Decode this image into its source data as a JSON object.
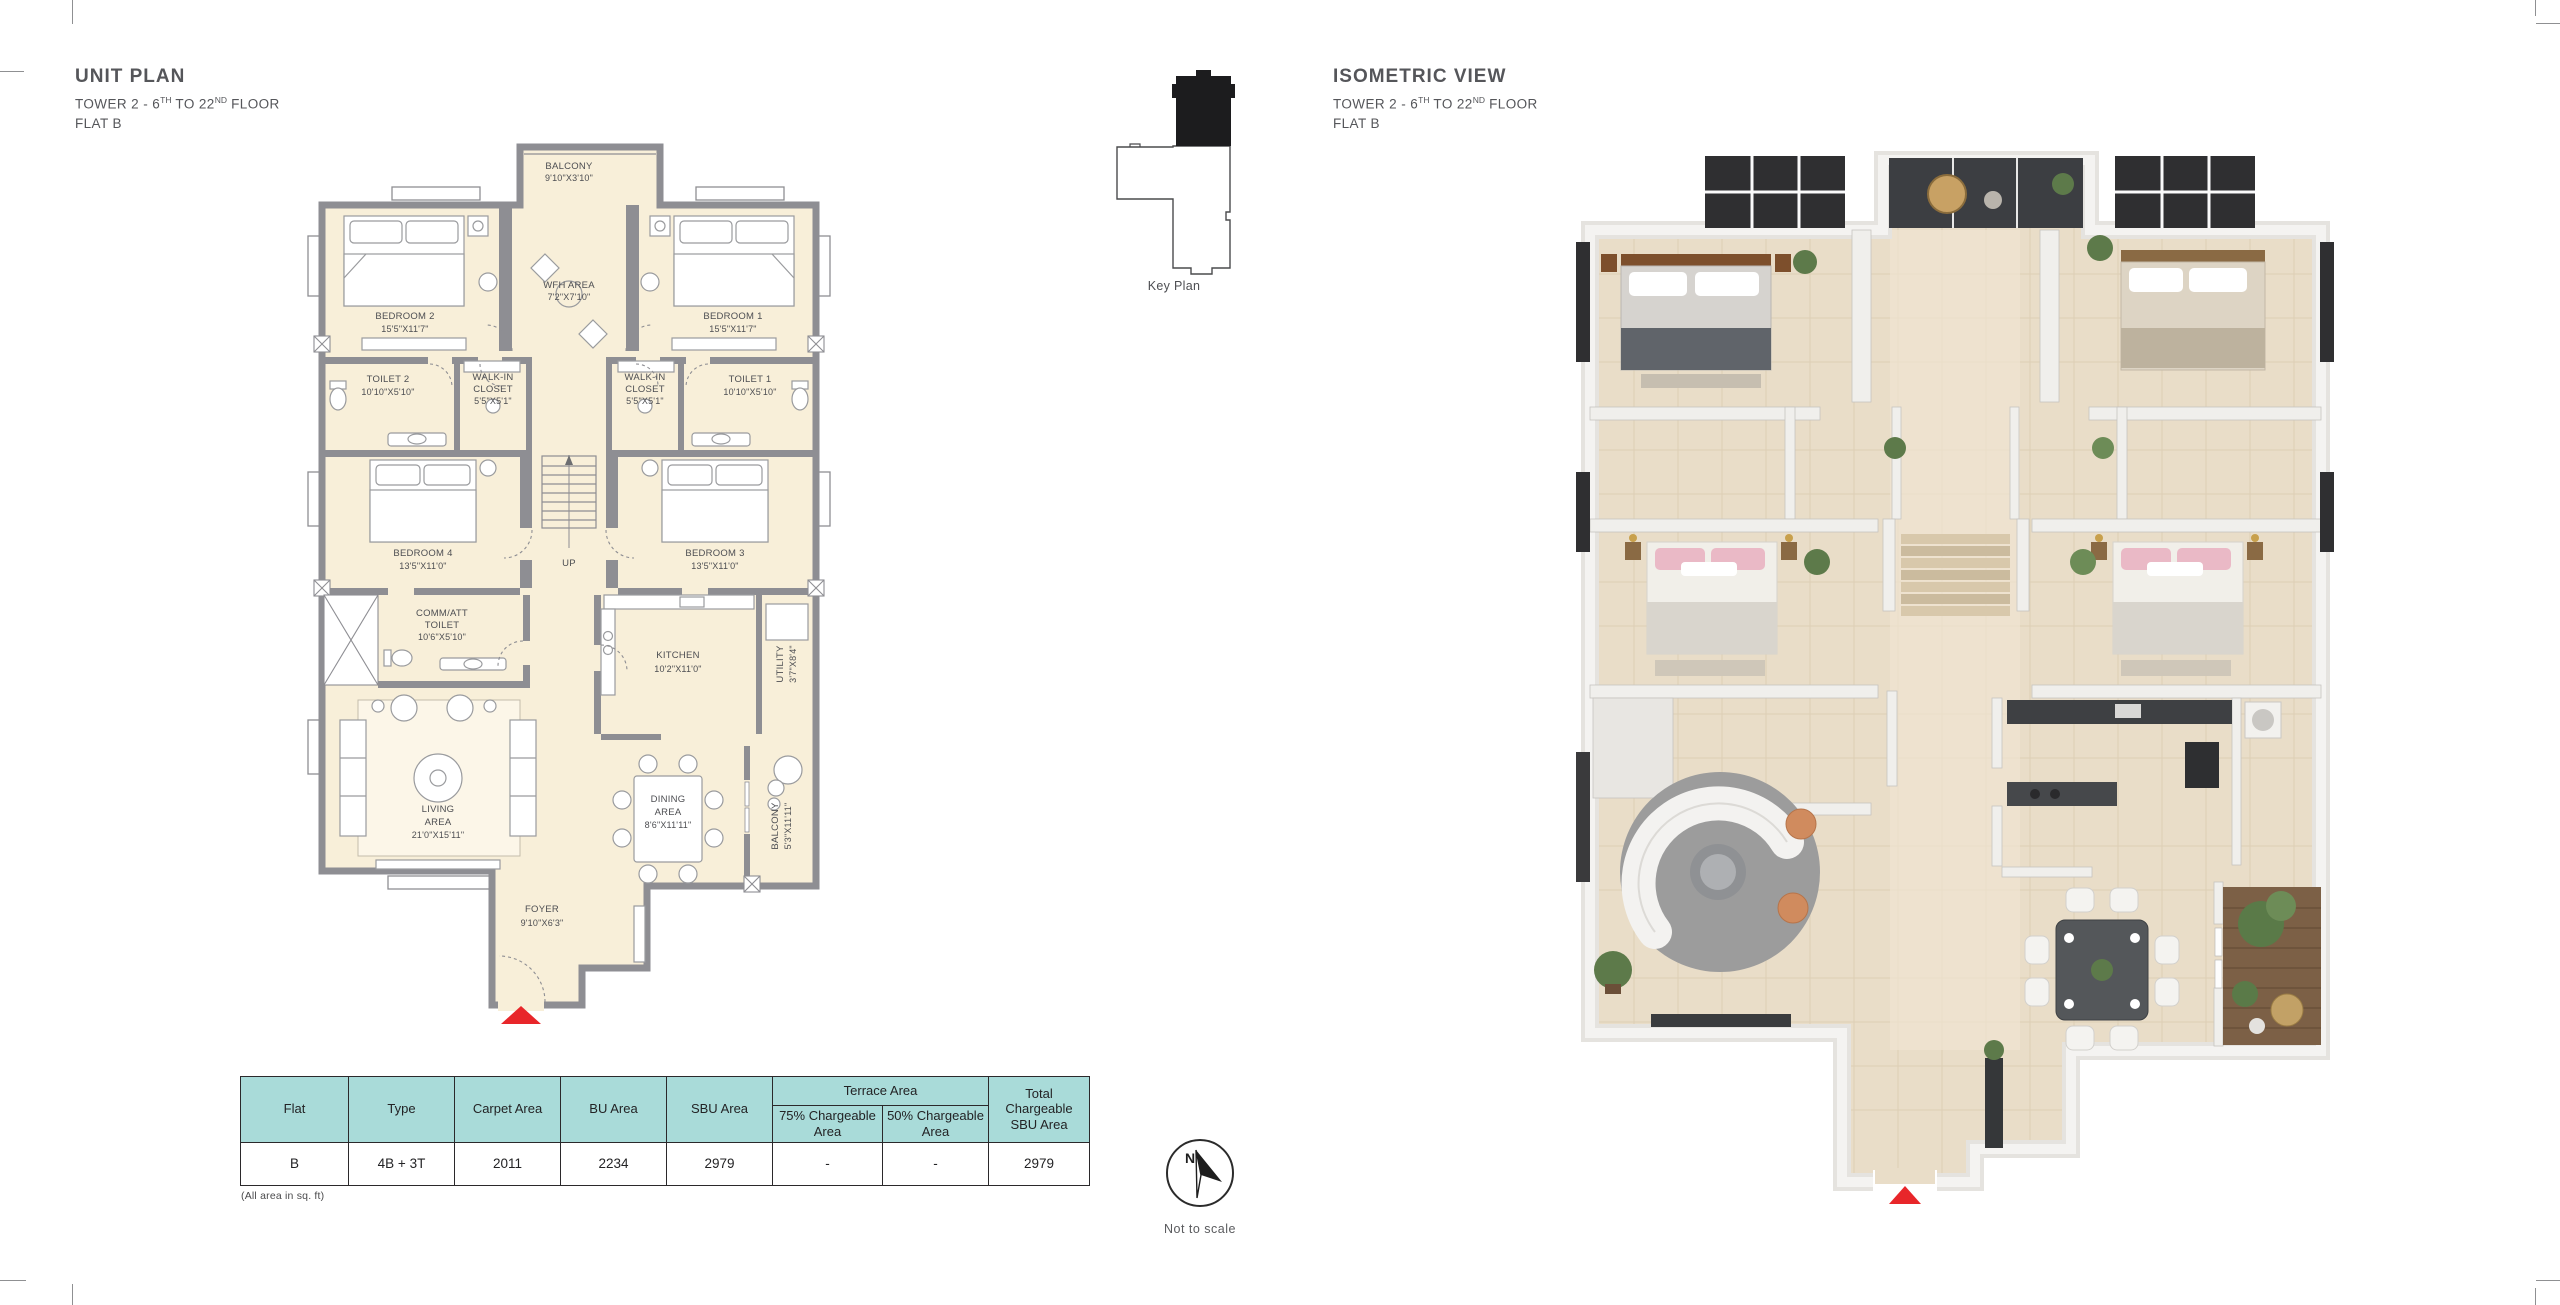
{
  "colors": {
    "floor_fill": "#f8efd9",
    "wall_gray": "#8e8e93",
    "furniture_line": "#9a9b9e",
    "text_gray": "#58595b",
    "table_header_teal": "#a9dbd9",
    "entry_arrow_red": "#e8262a",
    "iso_floor": "#e9ddc8",
    "iso_wall": "#f0efec"
  },
  "unit_plan": {
    "title": "UNIT PLAN",
    "subtitle": {
      "pre": "TOWER 2 - 6",
      "sup1": "TH",
      "mid": " TO 22",
      "sup2": "ND",
      "post": " FLOOR"
    },
    "flat": "FLAT B",
    "rooms": {
      "balcony_top": {
        "l1": "BALCONY",
        "l2": "9'10\"X3'10\""
      },
      "wfh": {
        "l1": "WFH AREA",
        "l2": "7'2\"X7'10\""
      },
      "bedroom2": {
        "l1": "BEDROOM 2",
        "l2": "15'5\"X11'7\""
      },
      "bedroom1": {
        "l1": "BEDROOM 1",
        "l2": "15'5\"X11'7\""
      },
      "toilet2": {
        "l1": "TOILET 2",
        "l2": "10'10\"X5'10\""
      },
      "closet_left": {
        "l1": "WALK-IN",
        "l2": "CLOSET",
        "l3": "5'5\"X5'1\""
      },
      "closet_right": {
        "l1": "WALK-IN",
        "l2": "CLOSET",
        "l3": "5'5\"X5'1\""
      },
      "toilet1": {
        "l1": "TOILET 1",
        "l2": "10'10\"X5'10\""
      },
      "stairs": {
        "l1": "UP"
      },
      "bedroom4": {
        "l1": "BEDROOM 4",
        "l2": "13'5\"X11'0\""
      },
      "bedroom3": {
        "l1": "BEDROOM 3",
        "l2": "13'5\"X11'0\""
      },
      "comm_toilet": {
        "l1": "COMM/ATT",
        "l2": "TOILET",
        "l3": "10'6\"X5'10\""
      },
      "kitchen": {
        "l1": "KITCHEN",
        "l2": "10'2\"X11'0\""
      },
      "utility": {
        "l1": "UTILITY",
        "l2": "3'7\"X8'4\""
      },
      "living": {
        "l1": "LIVING",
        "l2": "AREA",
        "l3": "21'0\"X15'11\""
      },
      "dining": {
        "l1": "DINING",
        "l2": "AREA",
        "l3": "8'6\"X11'11\""
      },
      "balcony_bottom": {
        "l1": "BALCONY",
        "l2": "5'3\"X11'11\""
      },
      "foyer": {
        "l1": "FOYER",
        "l2": "9'10\"X6'3\""
      }
    }
  },
  "key_plan": {
    "label": "Key Plan"
  },
  "isometric": {
    "title": "ISOMETRIC VIEW",
    "subtitle": {
      "pre": "TOWER 2 - 6",
      "sup1": "TH",
      "mid": " TO 22",
      "sup2": "ND",
      "post": " FLOOR"
    },
    "flat": "FLAT B"
  },
  "area_table": {
    "headers": {
      "flat": "Flat",
      "type": "Type",
      "carpet": "Carpet Area",
      "bu": "BU Area",
      "sbu": "SBU Area",
      "terrace_group": "Terrace Area",
      "terrace_75": "75% Chargeable Area",
      "terrace_50": "50% Chargeable Area",
      "total": "Total Chargeable SBU Area"
    },
    "row": {
      "flat": "B",
      "type": "4B + 3T",
      "carpet": "2011",
      "bu": "2234",
      "sbu": "2979",
      "terrace_75": "-",
      "terrace_50": "-",
      "total": "2979"
    },
    "footnote": "(All area in sq. ft)"
  },
  "compass": {
    "north_label": "N",
    "note": "Not to scale"
  }
}
